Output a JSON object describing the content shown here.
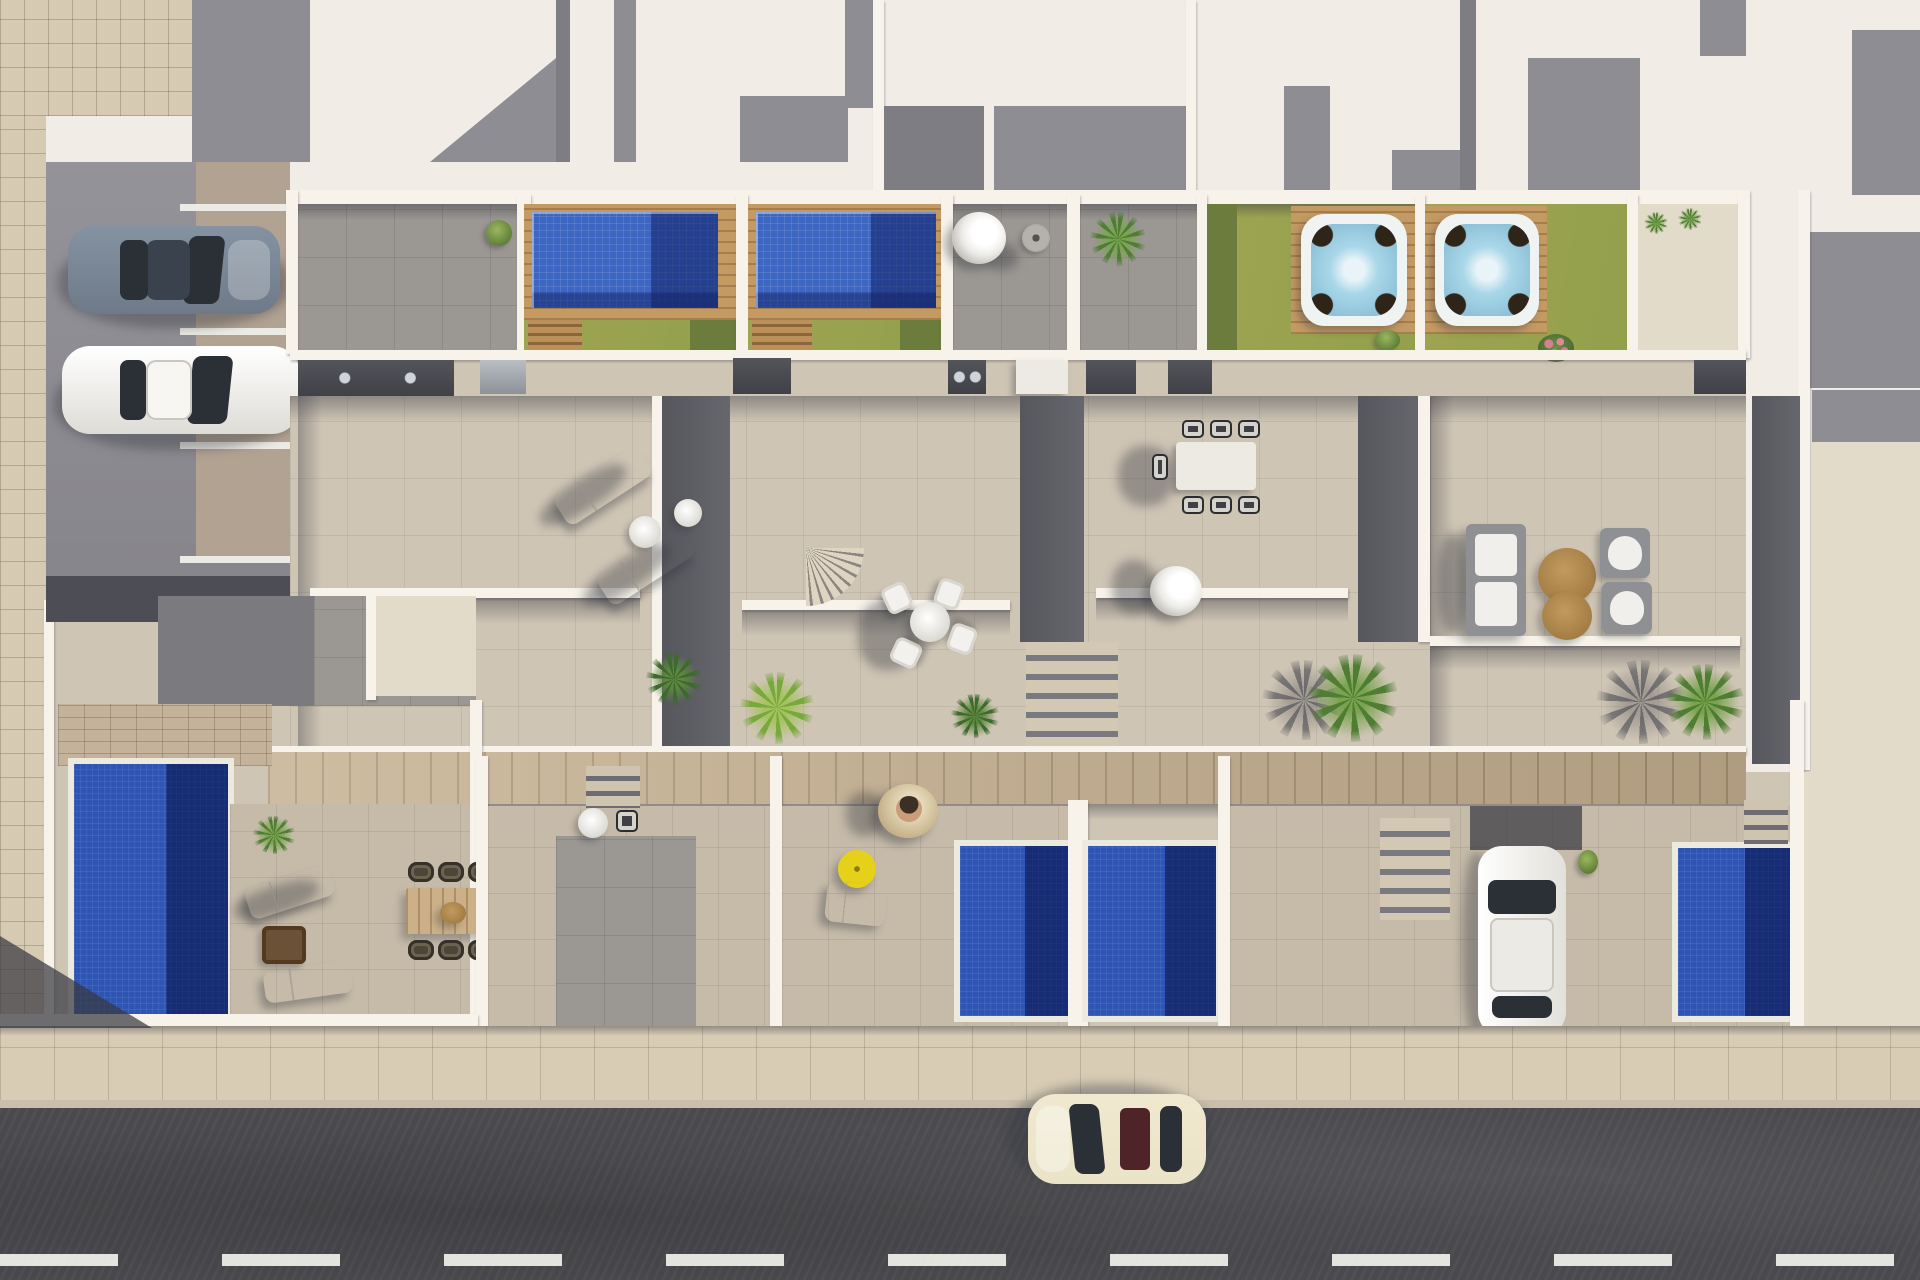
{
  "scene": {
    "type": "aerial-architectural-render",
    "description": "Top-down 3D rendering of a row of four new-build townhouses with roof terraces (two with mosaic plunge pools, two with hot tubs on timber decks and lawns), mid-level tiled terraces with outdoor furniture, street-level gardens each with a private pool, a left-side parking court with two parked cars, and an asphalt street with a dashed center line and one cream car at the bottom.",
    "text_content": "none"
  },
  "palette": {
    "roof-white": "#f1ede6",
    "roof-gray": "#8e8d93",
    "roof-gray-dark": "#7d7d83",
    "wall": "#f7f3ea",
    "tile-walkway": "#d7cab2",
    "stall": "#b2a292",
    "patio-gray": "#9b9793",
    "wood": "#c49a63",
    "wood-walkway": "#c4ae8e",
    "pool": "#3c66c2",
    "pool-deep": "#2e55b4",
    "pool-navy": "#16307e",
    "hottub-water": "#a9d7e9",
    "lawn": "#9ea452",
    "lawn-dark": "#6b7c3c",
    "terrace": "#cfc5b5",
    "garden-tile": "#c6bba9",
    "sidewalk": "#d8ccb5",
    "street": "#4a4a4e",
    "dash": "#f2f2ec",
    "kitchen": "#3f4146",
    "steel": "#8d9298",
    "strip": "#66676d",
    "glass": "#2b2f36",
    "car-gray": "#6e7a88",
    "car-white": "#f1efec",
    "car-cream": "#eae3c7",
    "sunroof": "#4f2428",
    "parasol": "#e5d01a",
    "rattan": "#cdbb94",
    "skin": "#c99d78",
    "brown-table": "#a07a42",
    "rose": "#d4808e",
    "palm-green": "#4f7d33",
    "palm-bright": "#79a83c"
  },
  "objects": {
    "vehicles": [
      {
        "name": "parked-car-gray",
        "color": "#6e7a88",
        "location": "left parking court, upper stall",
        "orientation": "horizontal"
      },
      {
        "name": "parked-car-white",
        "color": "#f1efec",
        "location": "left parking court, lower stall",
        "orientation": "horizontal"
      },
      {
        "name": "driveway-car-white",
        "color": "#f1efec",
        "location": "right street-level garden driveway",
        "orientation": "vertical"
      },
      {
        "name": "street-car-cream",
        "color": "#eae3c7",
        "location": "street at bottom",
        "orientation": "horizontal, facing left"
      }
    ],
    "water_features": [
      {
        "name": "rooftop-pool-1",
        "style": "blue mosaic with timber deck"
      },
      {
        "name": "rooftop-pool-2",
        "style": "blue mosaic with timber deck"
      },
      {
        "name": "hot-tub-1",
        "style": "white shell spa on timber deck over lawn"
      },
      {
        "name": "hot-tub-2",
        "style": "white shell spa on timber deck over lawn"
      },
      {
        "name": "garden-pool-left",
        "style": "deep blue plunge pool"
      },
      {
        "name": "garden-pool-middle-1",
        "style": "deep blue plunge pool"
      },
      {
        "name": "garden-pool-middle-2",
        "style": "deep blue plunge pool"
      },
      {
        "name": "garden-pool-right",
        "style": "deep blue plunge pool"
      }
    ],
    "furniture": [
      {
        "name": "sun-loungers-terrace-1",
        "count": 2,
        "color": "white"
      },
      {
        "name": "ball-lamp-and-side-table",
        "count": 2
      },
      {
        "name": "round-dining-set-terrace-2",
        "chairs": 4,
        "color": "white"
      },
      {
        "name": "rect-dining-set-terrace-3",
        "chairs": 7,
        "table": "white"
      },
      {
        "name": "hanging-egg-chairs",
        "count": 3
      },
      {
        "name": "lounge-sofa-set-terrace-4",
        "pieces": "sofa, 2 armchairs, 2 round brown coffee tables"
      },
      {
        "name": "outdoor-kitchens",
        "count": 5,
        "color": "anthracite"
      },
      {
        "name": "wood-dining-set-lower-left",
        "chairs": 6,
        "style": "dark wicker"
      },
      {
        "name": "garden-loungers-lower-left",
        "count": 3
      },
      {
        "name": "yellow-parasol",
        "count": 1
      },
      {
        "name": "fire-table",
        "count": 1
      }
    ],
    "landscape": [
      {
        "name": "lawns",
        "color": "#9ea452"
      },
      {
        "name": "palms-and-shrubs",
        "count": 12
      },
      {
        "name": "rose-bush",
        "color": "#d4808e"
      }
    ],
    "structure": {
      "units": 4,
      "levels": [
        "roof terraces with pools and hot tubs",
        "mid-level tiled terraces",
        "street-level gardens with pools"
      ],
      "street_markings": "white dashed center line",
      "parking_stalls": 3
    }
  }
}
